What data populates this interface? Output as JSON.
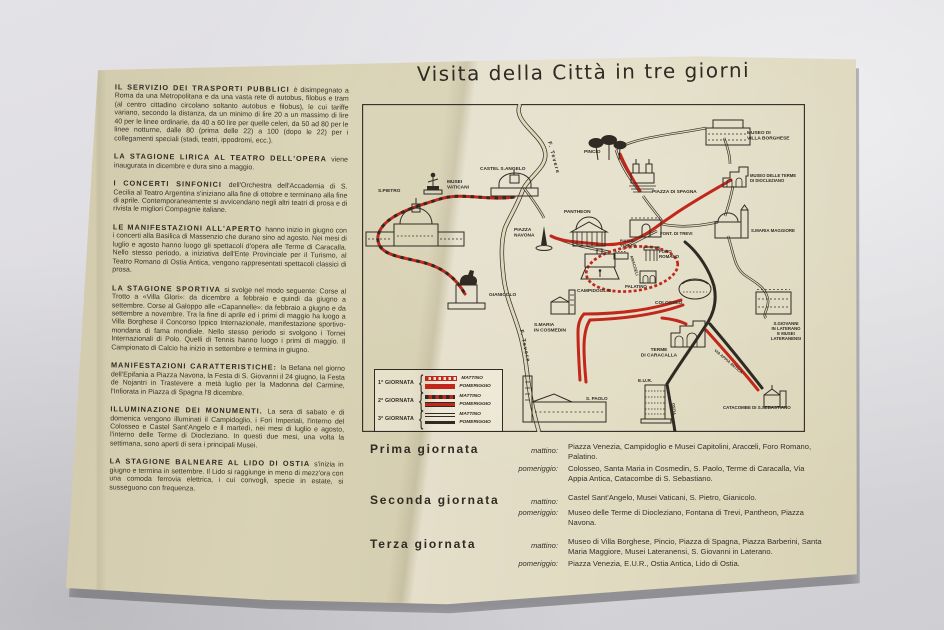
{
  "colors": {
    "red": "#c1271b",
    "ink": "#2f2a23",
    "paper": "#dbd4b6"
  },
  "title": "Visita della Città in tre giorni",
  "left_column": {
    "paragraphs": [
      {
        "head": "IL SERVIZIO DEI TRASPORTI PUBBLICI",
        "text": "è disimpegnato a Roma da una Metropolitana e da una vasta rete di autobus, filobus e tram (al centro cittadino circolano soltanto autobus e filobus), le cui tariffe variano, secondo la distanza, da un minimo di lire 20 a un massimo di lire 40 per le linee ordinarie, da 40 a 60 lire per quelle celeri, da 50 ad 80 per le linee notturne, dalle 80 (prima delle 22) a 100 (dopo le 22) per i collegamenti speciali (stadi, teatri, ippodromi, ecc.)."
      },
      {
        "head": "LA STAGIONE LIRICA AL TEATRO DELL'OPERA",
        "text": "viene inaugurata in dicembre e dura sino a maggio."
      },
      {
        "head": "I CONCERTI SINFONICI",
        "text": "dell'Orchestra dell'Accademia di S. Cecilia al Teatro Argentina s'iniziano alla fine di ottobre e terminano alla fine di aprile. Contemporaneamente si avvicendano negli altri teatri di prosa e di rivista le migliori Compagnie italiane."
      },
      {
        "head": "LE MANIFESTAZIONI ALL'APERTO",
        "text": "hanno inizio in giugno con i concerti alla Basilica di Massenzio che durano sino ad agosto. Nei mesi di luglio e agosto hanno luogo gli spettacoli d'opera alle Terme di Caracalla. Nello stesso periodo, a iniziativa dell'Ente Provinciale per il Turismo, al Teatro Romano di Ostia Antica, vengono rappresentati spettacoli classici di prosa."
      },
      {
        "head": "LA STAGIONE SPORTIVA",
        "text": "si svolge nel modo seguente: Corse al Trotto a «Villa Glori»: da dicembre a febbraio e quindi da giugno a settembre. Corse al Galoppo alle «Capannelle»: da febbraio a giugno e da settembre a novembre. Tra la fine di aprile ed i primi di maggio ha luogo a Villa Borghese il Concorso Ippico Internazionale, manifestazione sportivo-mondana di fama mondiale. Nello stesso periodo si svolgono i Tornei Internazionali di Polo. Quelli di Tennis hanno luogo i primi di maggio. Il Campionato di Calcio ha inizio in settembre e termina in giugno."
      },
      {
        "head": "MANIFESTAZIONI CARATTERISTICHE:",
        "text": "la Befana nel giorno dell'Epifania a Piazza Navona, la Festa di S. Giovanni il 24 giugno, la Festa de Nojantri in Trastevere a metà luglio per la Madonna del Carmine, l'Infiorata in Piazza di Spagna l'8 dicembre."
      },
      {
        "head": "ILLUMINAZIONE DEI MONUMENTI.",
        "text": "La sera di sabato e di domenica vengono illuminati il Campidoglio, i Fori Imperiali, l'interno del Colosseo e Castel Sant'Angelo e il martedì, nei mesi di luglio e agosto, l'interno delle Terme di Diocleziano. In questi due mesi, una volta la settimana, sono aperti di sera i principali Musei."
      },
      {
        "head": "LA STAGIONE BALNEARE AL LIDO DI OSTIA",
        "text": "s'inizia in giugno e termina in settembre. Il Lido si raggiunge in meno di mezz'ora con una comoda ferrovia elettrica, i cui convogli, specie in estate, si susseguono con frequenza."
      }
    ]
  },
  "map": {
    "labels": [
      {
        "text": "CASTEL S.ANGELO",
        "x": 118,
        "y": 66
      },
      {
        "text": "MUSEI\nVATICANI",
        "x": 85,
        "y": 79
      },
      {
        "text": "S.PIETRO",
        "x": 16,
        "y": 88
      },
      {
        "text": "PINCIO",
        "x": 222,
        "y": 49
      },
      {
        "text": "MUSEO DI\nVILLA BORGHESE",
        "x": 385,
        "y": 30
      },
      {
        "text": "MUSEO DELLE TERME\nDI DIOCLEZIANO",
        "x": 388,
        "y": 73,
        "size": 4.2
      },
      {
        "text": "PIAZZA DI SPAGNA",
        "x": 290,
        "y": 89
      },
      {
        "text": "S.MARIA MAGGIORE",
        "x": 389,
        "y": 128,
        "size": 4.4
      },
      {
        "text": "PANTHEON",
        "x": 202,
        "y": 109
      },
      {
        "text": "FONT. DI TREVI",
        "x": 298,
        "y": 131,
        "size": 4.4
      },
      {
        "text": "PIAZZA\nNAVONA",
        "x": 152,
        "y": 127
      },
      {
        "text": "PIAZZA\nVENEZIA",
        "x": 258,
        "y": 138,
        "size": 3.8
      },
      {
        "text": "CAMPIDOGLIO",
        "x": 215,
        "y": 188
      },
      {
        "text": "ARACOELI",
        "x": 268,
        "y": 152,
        "rotate": 73,
        "size": 4
      },
      {
        "text": "FORO\nROMANO",
        "x": 297,
        "y": 149,
        "size": 4.4
      },
      {
        "text": "PALATINO",
        "x": 263,
        "y": 184,
        "size": 4.4
      },
      {
        "text": "COLOSSEO",
        "x": 293,
        "y": 200
      },
      {
        "text": "GIANICOLO",
        "x": 127,
        "y": 192
      },
      {
        "text": "S.MARIA\nIN COSMEDIN",
        "x": 172,
        "y": 222
      },
      {
        "text": "F. Tevere",
        "x": 186,
        "y": 38,
        "rotate": 75,
        "size": 5.4,
        "spacing": 1.2
      },
      {
        "text": "F. Tevere",
        "x": 158,
        "y": 226,
        "rotate": 78,
        "size": 5.4,
        "spacing": 1.2
      },
      {
        "text": "TERME\nDI CARACALLA",
        "x": 297,
        "y": 247,
        "anchor": "middle"
      },
      {
        "text": "S.GIOVANNI\nIN LATERANO\nE MUSEI\nLATERANENSI",
        "x": 424,
        "y": 221,
        "anchor": "middle",
        "size": 4.3
      },
      {
        "text": "VIA APPIA ANTICA",
        "x": 352,
        "y": 247,
        "rotate": 40,
        "size": 4
      },
      {
        "text": "E.U.R.",
        "x": 276,
        "y": 278
      },
      {
        "text": "OSTIA",
        "x": 310,
        "y": 299,
        "rotate": 85,
        "size": 4
      },
      {
        "text": "S. PAOLO",
        "x": 224,
        "y": 296,
        "size": 4.6
      },
      {
        "text": "CATACOMBE DI S.SEBASTIANO",
        "x": 361,
        "y": 305,
        "size": 4.4
      }
    ],
    "legend": {
      "rows": [
        {
          "day": "1ª GIORNATA",
          "entries": [
            {
              "label": "MATTINO",
              "swatch": "d1m"
            },
            {
              "label": "POMERIGGIO",
              "swatch": "d1p"
            }
          ]
        },
        {
          "day": "2ª GIORNATA",
          "entries": [
            {
              "label": "MATTINO",
              "swatch": "d2m"
            },
            {
              "label": "POMERIGGIO",
              "swatch": "d2p"
            }
          ]
        },
        {
          "day": "3ª GIORNATA",
          "entries": [
            {
              "label": "MATTINO",
              "swatch": "d3m"
            },
            {
              "label": "POMERIGGIO",
              "swatch": "d3p"
            }
          ]
        }
      ]
    }
  },
  "itinerary": {
    "days": [
      {
        "name": "Prima giornata",
        "periods": [
          {
            "label": "mattino:",
            "text": "Piazza Venezia, Campidoglio e Musei Capitolini, Aracœli, Foro Romano, Palatino."
          },
          {
            "label": "pomeriggio:",
            "text": "Colosseo, Santa Maria in Cosmedin, S. Paolo, Terme di Caracalla, Via Appia Antica, Catacombe di S. Sebastiano."
          }
        ]
      },
      {
        "name": "Seconda giornata",
        "periods": [
          {
            "label": "mattino:",
            "text": "Castel Sant'Angelo, Musei Vaticani, S. Pietro, Gianicolo."
          },
          {
            "label": "pomeriggio:",
            "text": "Museo delle Terme di Diocleziano, Fontana di Trevi, Pantheon, Piazza Navona."
          }
        ]
      },
      {
        "name": "Terza giornata",
        "periods": [
          {
            "label": "mattino:",
            "text": "Museo di Villa Borghese, Pincio, Piazza di Spagna, Piazza Barberini, Santa Maria Maggiore, Musei Lateranensi, S. Giovanni in Laterano."
          },
          {
            "label": "pomeriggio:",
            "text": "Piazza Venezia, E.U.R., Ostia Antica, Lido di Ostia."
          }
        ]
      }
    ]
  }
}
